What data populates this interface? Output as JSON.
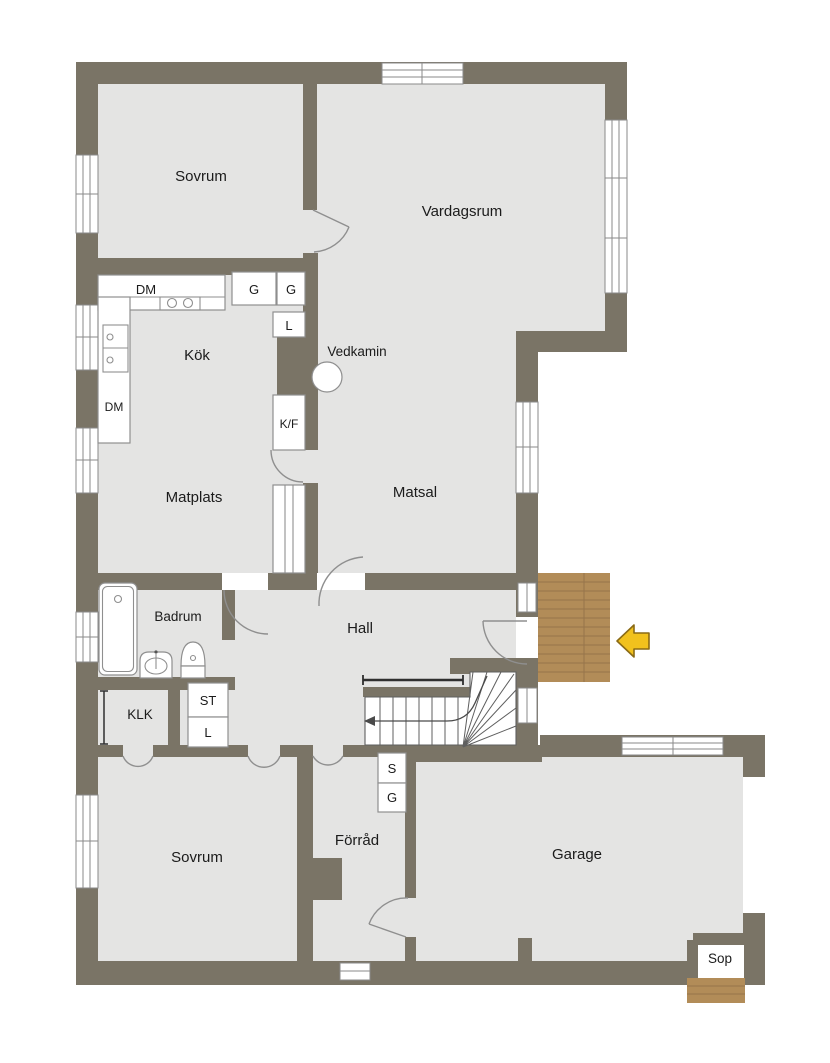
{
  "plan_type": "floor-plan",
  "colors": {
    "wall": "#7a7466",
    "floor": "#e4e4e3",
    "deck": "#b28c58",
    "deck_line": "#96744a",
    "arrow_fill": "#f1c11d",
    "arrow_stroke": "#8a6a15"
  },
  "labels": {
    "sovrum_top": "Sovrum",
    "vardagsrum": "Vardagsrum",
    "kok": "Kök",
    "vedkamin": "Vedkamin",
    "matplats": "Matplats",
    "matsal": "Matsal",
    "hall": "Hall",
    "badrum": "Badrum",
    "klk": "KLK",
    "st_cabinet": "ST",
    "l_hall": "L",
    "sovrum_bottom": "Sovrum",
    "forrad": "Förråd",
    "garage": "Garage",
    "sop": "Sop",
    "dm_counter": "DM",
    "dm_left": "DM",
    "g_cabinet_1": "G",
    "g_cabinet_2": "G",
    "l_kitchen": "L",
    "kf": "K/F",
    "s_cabinet": "S",
    "g_cabinet_3": "G"
  }
}
